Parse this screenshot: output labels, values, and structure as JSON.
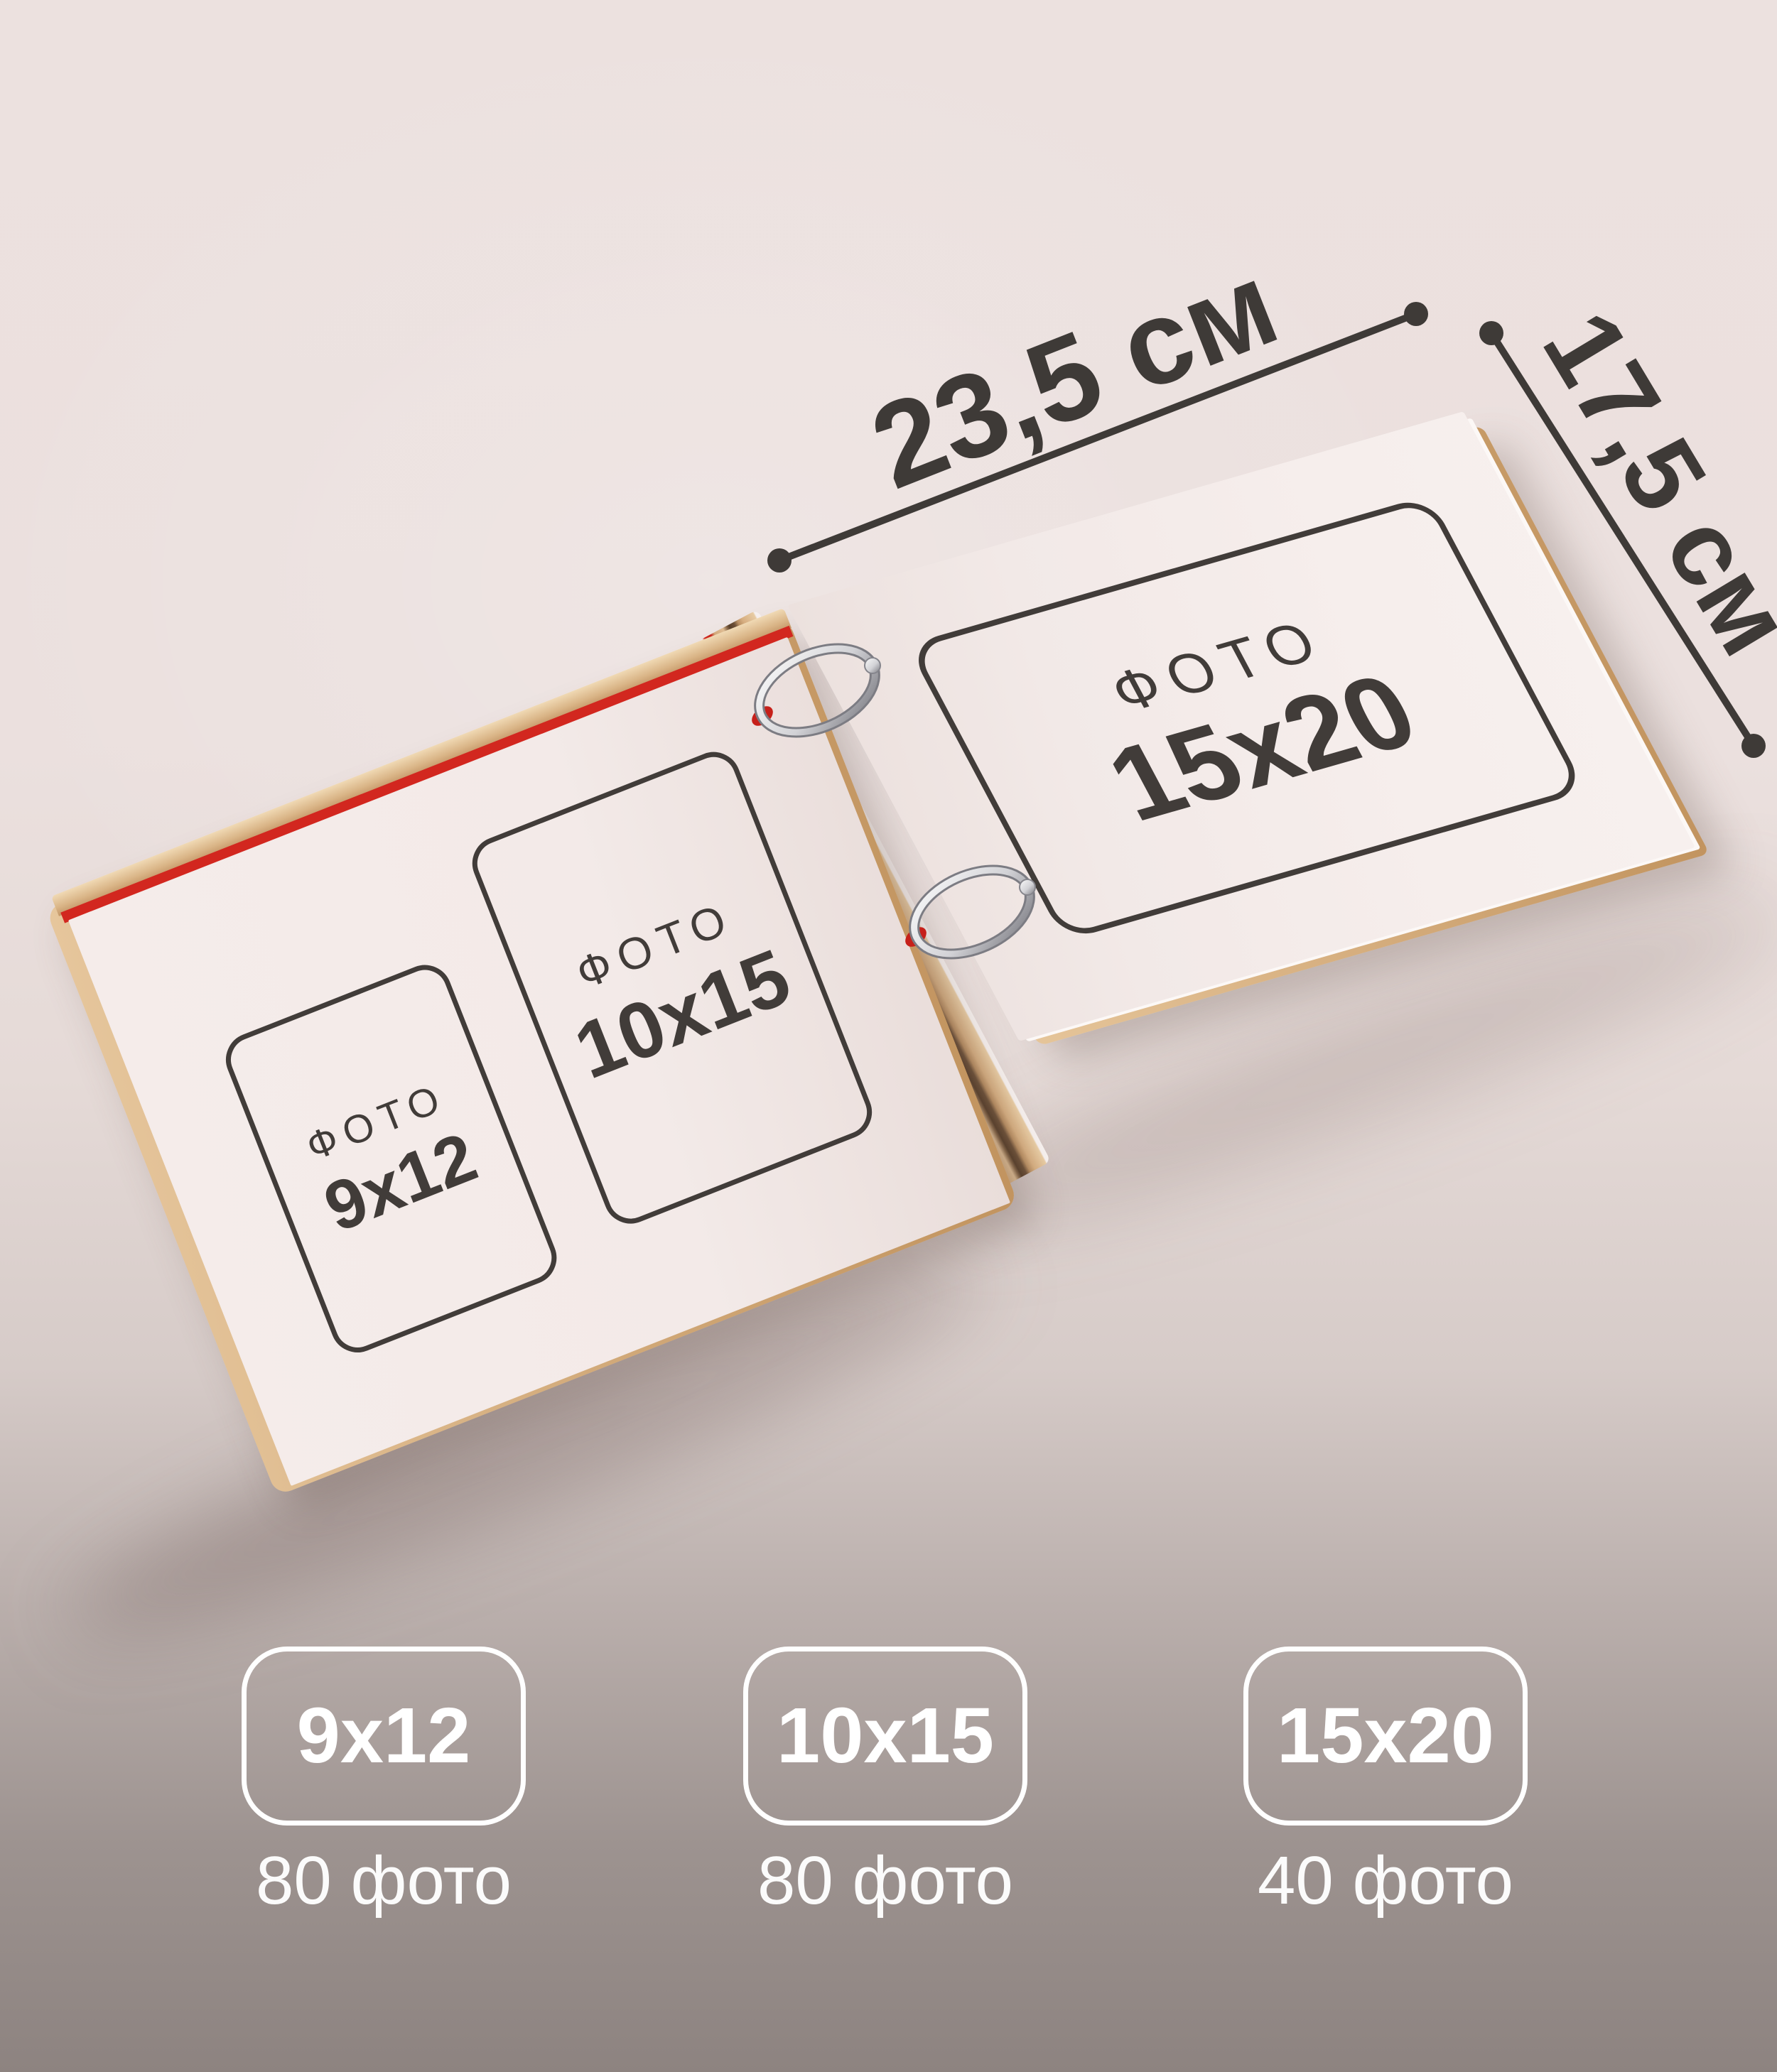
{
  "dimensions": {
    "width_label": "23,5 см",
    "height_label": "17,5 см"
  },
  "album": {
    "right_page": {
      "frame": {
        "photo_label": "ФОТО",
        "size_label": "15x20"
      }
    },
    "left_page": {
      "frames": [
        {
          "photo_label": "ФОТО",
          "size_label": "9x12"
        },
        {
          "photo_label": "ФОТО",
          "size_label": "10x15"
        }
      ]
    }
  },
  "badges": [
    {
      "size": "9x12",
      "capacity": "80 фото"
    },
    {
      "size": "10x15",
      "capacity": "80 фото"
    },
    {
      "size": "15x20",
      "capacity": "40 фото"
    }
  ],
  "colors": {
    "annotation_dark": "#3e3a37",
    "accent_red": "#d2271f",
    "wood": "#d9b486",
    "page_white": "#f3eae8",
    "badge_white": "#ffffff",
    "background_top": "#ece1df",
    "background_bottom": "#8d8380"
  }
}
